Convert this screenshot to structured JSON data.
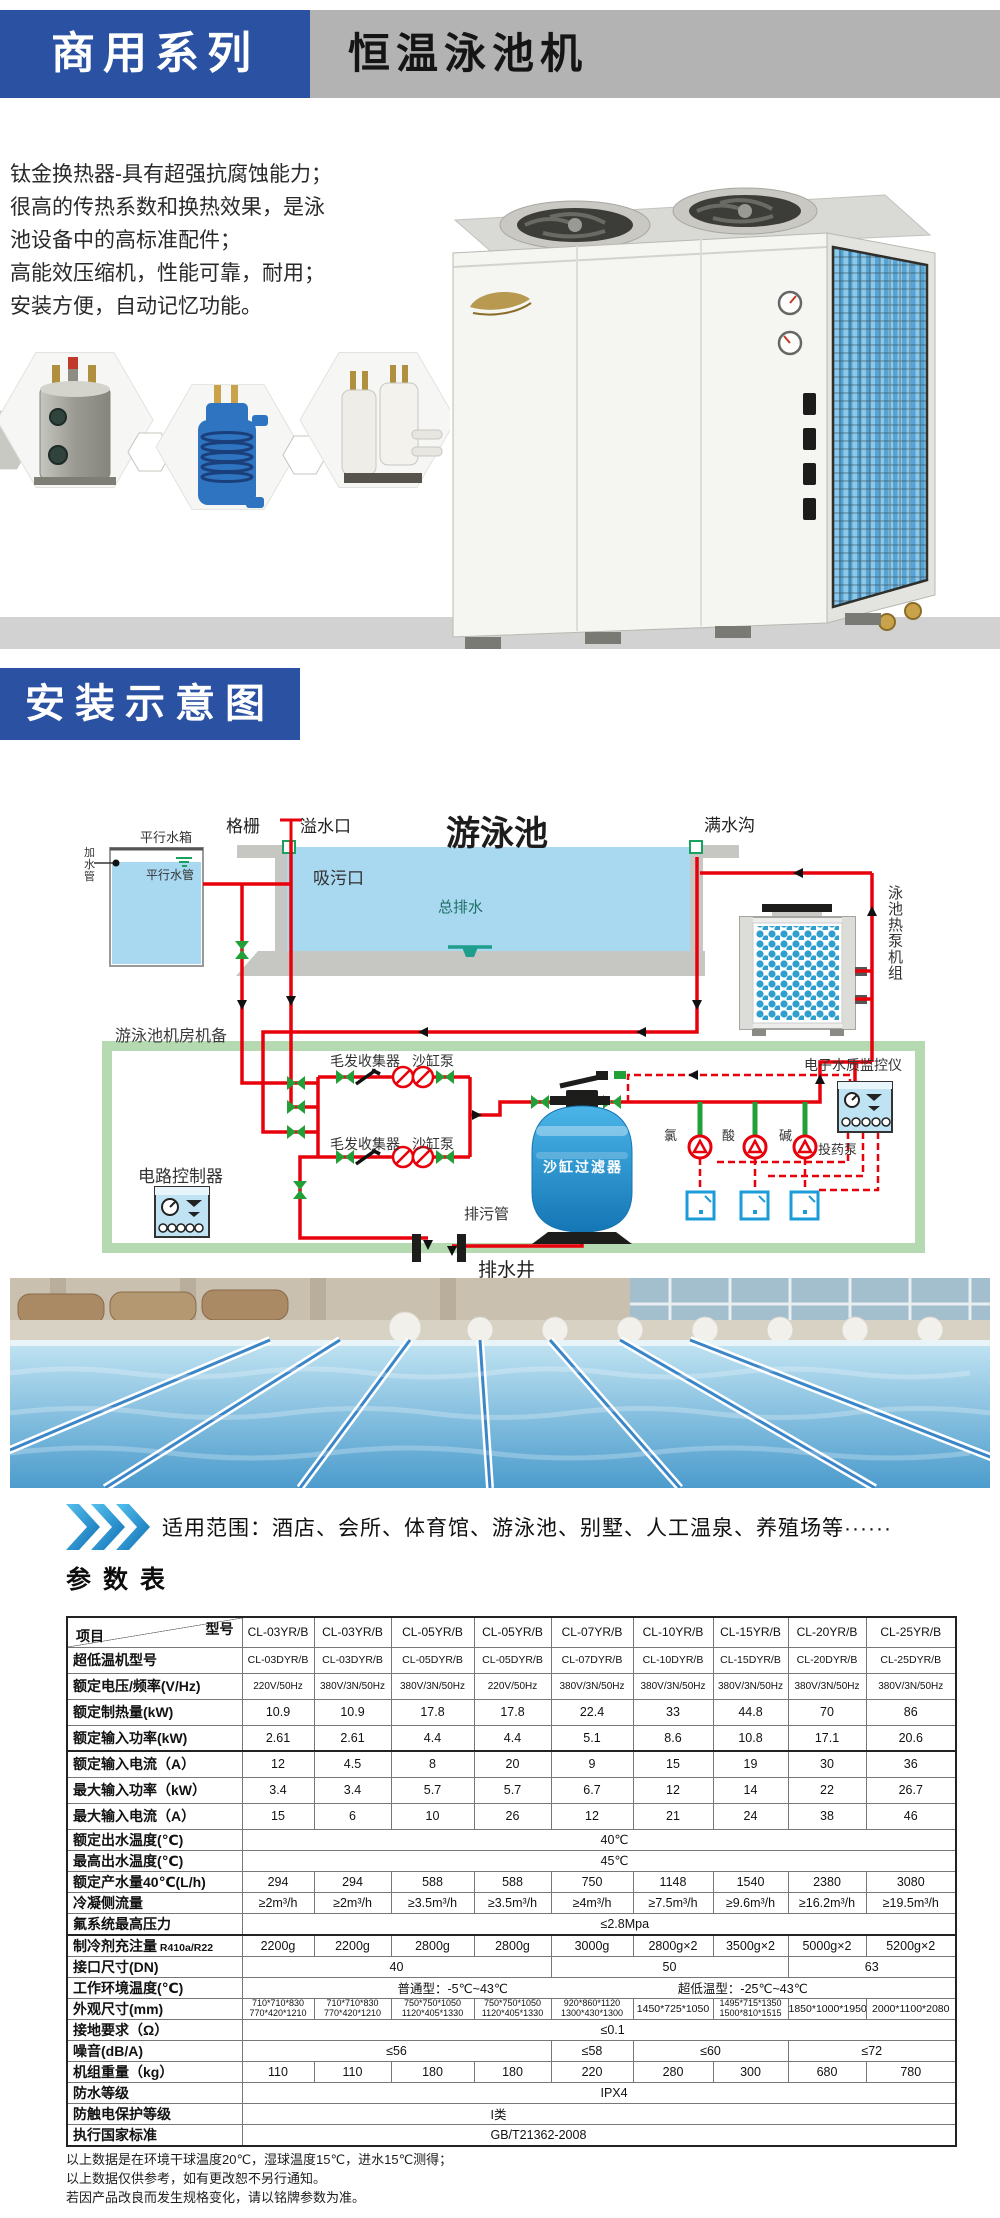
{
  "header": {
    "series_label": "商用系列",
    "product_title": "恒温泳池机"
  },
  "intro": {
    "lines": [
      "钛金换热器-具有超强抗腐蚀能力；",
      "很高的传热系数和换热效果，是泳",
      "池设备中的高标准配件；",
      "高能效压缩机，性能可靠，耐用；",
      "安装方便，自动记忆功能。"
    ]
  },
  "install": {
    "title": "安装示意图"
  },
  "diagram": {
    "labels": {
      "tank": "平行水箱",
      "fill_pipe": "加水管",
      "parallel_pipe": "平行水管",
      "grille": "格栅",
      "overflow": "溢水口",
      "pool": "游泳池",
      "gutter": "满水沟",
      "suction": "吸污口",
      "main_drain": "总排水",
      "unit": "泳池热泵机组",
      "room": "游泳池机房机备",
      "hair_collector": "毛发收集器",
      "sand_pump": "沙缸泵",
      "controller": "电路控制器",
      "monitor": "电子水质监控仪",
      "chlorine": "氯",
      "acid": "酸",
      "alkali": "碱",
      "dosing_pump": "投药泵",
      "sand_filter": "沙缸过滤器",
      "blowdown_pipe": "排污管",
      "drain_well": "排水井"
    }
  },
  "applicable": {
    "text": "适用范围：酒店、会所、体育馆、游泳池、别墅、人工温泉、养殖场等······"
  },
  "table": {
    "title": "参数表",
    "corner_top": "型号",
    "corner_bottom": "项目",
    "models": [
      "CL-03YR/B",
      "CL-03YR/B",
      "CL-05YR/B",
      "CL-05YR/B",
      "CL-07YR/B",
      "CL-10YR/B",
      "CL-15YR/B",
      "CL-20YR/B",
      "CL-25YR/B"
    ],
    "rows": [
      {
        "label": "超低温机型号",
        "cellcls": "sm2",
        "cells": [
          "CL-03DYR/B",
          "CL-03DYR/B",
          "CL-05DYR/B",
          "CL-05DYR/B",
          "CL-07DYR/B",
          "CL-10DYR/B",
          "CL-15DYR/B",
          "CL-20DYR/B",
          "CL-25DYR/B"
        ]
      },
      {
        "label": "额定电压/频率(V/Hz)",
        "cellcls": "sm",
        "cells": [
          "220V/50Hz",
          "380V/3N/50Hz",
          "380V/3N/50Hz",
          "220V/50Hz",
          "380V/3N/50Hz",
          "380V/3N/50Hz",
          "380V/3N/50Hz",
          "380V/3N/50Hz",
          "380V/3N/50Hz"
        ]
      },
      {
        "label": "额定制热量(kW)",
        "cells": [
          "10.9",
          "10.9",
          "17.8",
          "17.8",
          "22.4",
          "33",
          "44.8",
          "70",
          "86"
        ]
      },
      {
        "label": "额定输入功率(kW)",
        "cells": [
          "2.61",
          "2.61",
          "4.4",
          "4.4",
          "5.1",
          "8.6",
          "10.8",
          "17.1",
          "20.6"
        ]
      },
      {
        "label": "额定输入电流（A）",
        "topline": true,
        "cells": [
          "12",
          "4.5",
          "8",
          "20",
          "9",
          "15",
          "19",
          "30",
          "36"
        ]
      },
      {
        "label": "最大输入功率（kW）",
        "cells": [
          "3.4",
          "3.4",
          "5.7",
          "5.7",
          "6.7",
          "12",
          "14",
          "22",
          "26.7"
        ]
      },
      {
        "label": "最大输入电流（A）",
        "cells": [
          "15",
          "6",
          "10",
          "26",
          "12",
          "21",
          "24",
          "38",
          "46"
        ]
      },
      {
        "label": "额定出水温度(℃)",
        "cells": [
          {
            "t": "40℃",
            "s": 9,
            "cls": "pad-a"
          }
        ]
      },
      {
        "label": "最高出水温度(℃)",
        "cells": [
          {
            "t": "45℃",
            "s": 9,
            "cls": "pad-a"
          }
        ]
      },
      {
        "label": "额定产水量40℃(L/h)",
        "cells": [
          "294",
          "294",
          "588",
          "588",
          "750",
          "1148",
          "1540",
          "2380",
          "3080"
        ]
      },
      {
        "label": "冷凝侧流量",
        "cells": [
          "≥2m³/h",
          "≥2m³/h",
          "≥3.5m³/h",
          "≥3.5m³/h",
          "≥4m³/h",
          "≥7.5m³/h",
          "≥9.6m³/h",
          "≥16.2m³/h",
          "≥19.5m³/h"
        ]
      },
      {
        "label": "氟系统最高压力",
        "cells": [
          {
            "t": "≤2.8Mpa",
            "s": 9,
            "cls": "pad-a"
          }
        ]
      },
      {
        "label": "制冷剂充注量",
        "label_small": "R410a/R22",
        "topline": true,
        "cells": [
          "2200g",
          "2200g",
          "2800g",
          "2800g",
          "3000g",
          "2800g×2",
          "3500g×2",
          "5000g×2",
          "5200g×2"
        ]
      },
      {
        "label": "接口尺寸(DN)",
        "cells": [
          {
            "t": "40",
            "s": 4
          },
          {
            "t": "50",
            "s": 3
          },
          {
            "t": "63",
            "s": 2
          }
        ]
      },
      {
        "label": "工作环境温度(℃)",
        "cells": [
          {
            "pair": [
              "普通型：-5℃~43℃",
              "超低温型：-25℃~43℃"
            ],
            "s": 9
          }
        ]
      },
      {
        "label": "外观尺寸(mm)",
        "cellcls": "xs",
        "cells": [
          {
            "t": [
              "710*710*830",
              "770*420*1210"
            ]
          },
          {
            "t": [
              "710*710*830",
              "770*420*1210"
            ]
          },
          {
            "t": [
              "750*750*1050",
              "1120*405*1330"
            ]
          },
          {
            "t": [
              "750*750*1050",
              "1120*405*1330"
            ]
          },
          {
            "t": [
              "920*860*1120",
              "1300*430*1300"
            ]
          },
          {
            "t": [
              "1450*725*1050"
            ],
            "cls": "md"
          },
          {
            "t": [
              "1495*715*1350",
              "1500*810*1515"
            ]
          },
          {
            "t": [
              "1850*1000*1950"
            ],
            "cls": "md"
          },
          {
            "t": [
              "2000*1100*2080"
            ],
            "cls": "md"
          }
        ]
      },
      {
        "label": "接地要求（Ω）",
        "cells": [
          {
            "t": "≤0.1",
            "s": 9,
            "cls": "pad-a"
          }
        ]
      },
      {
        "label": "噪音(dB/A)",
        "cells": [
          {
            "t": "≤56",
            "s": 4
          },
          {
            "t": "≤58",
            "s": 1
          },
          {
            "t": "≤60",
            "s": 2
          },
          {
            "t": "≤72",
            "s": 2
          }
        ]
      },
      {
        "label": "机组重量（kg）",
        "cells": [
          "110",
          "110",
          "180",
          "180",
          "220",
          "280",
          "300",
          "680",
          "780"
        ]
      },
      {
        "label": "防水等级",
        "cells": [
          {
            "t": "IPX4",
            "s": 9,
            "cls": "pad-a"
          }
        ]
      },
      {
        "label": "防触电保护等级",
        "cells": [
          {
            "t": "I类",
            "s": 9,
            "cls": "pad-b"
          }
        ]
      },
      {
        "label": "执行国家标准",
        "cells": [
          {
            "t": "GB/T21362-2008",
            "s": 9,
            "cls": "pad-b"
          }
        ]
      }
    ]
  },
  "notes": [
    "以上数据是在环境干球温度20℃，湿球温度15℃，进水15℃测得；",
    "以上数据仅供参考，如有更改恕不另行通知。",
    "若因产品改良而发生规格变化，请以铭牌参数为准。"
  ]
}
